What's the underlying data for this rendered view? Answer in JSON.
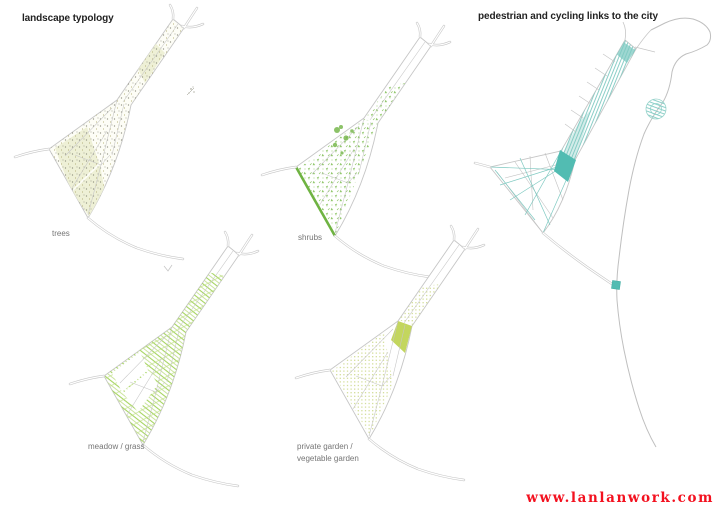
{
  "titles": {
    "left": "landscape typology",
    "right": "pedestrian and cycling links to the city"
  },
  "maps": {
    "trees": {
      "label": "trees"
    },
    "shrubs": {
      "label": "shrubs"
    },
    "meadow": {
      "label": "meadow / grass"
    },
    "garden": {
      "label_line1": "private garden /",
      "label_line2": "vegetable garden"
    },
    "links": {
      "label": ""
    }
  },
  "watermark": {
    "text": "www.lanlanwork.com"
  },
  "colors": {
    "background": "#ffffff",
    "title_text": "#222222",
    "label_text": "#757575",
    "road_gray": "#c6c6c6",
    "trees_dot": "#8b8b7b",
    "trees_olive": "#a6a062",
    "trees_patch": "#eef0d6",
    "shrub_green": "#8cc465",
    "shrub_dark": "#6fb342",
    "meadow_green": "#a5d45f",
    "meadow_light": "#bede85",
    "garden_pale": "#cdd98b",
    "garden_solid": "#c3d65e",
    "link_teal": "#7ec9c1",
    "link_teal_solid": "#52bcb2",
    "watermark_red": "#f3111f"
  }
}
